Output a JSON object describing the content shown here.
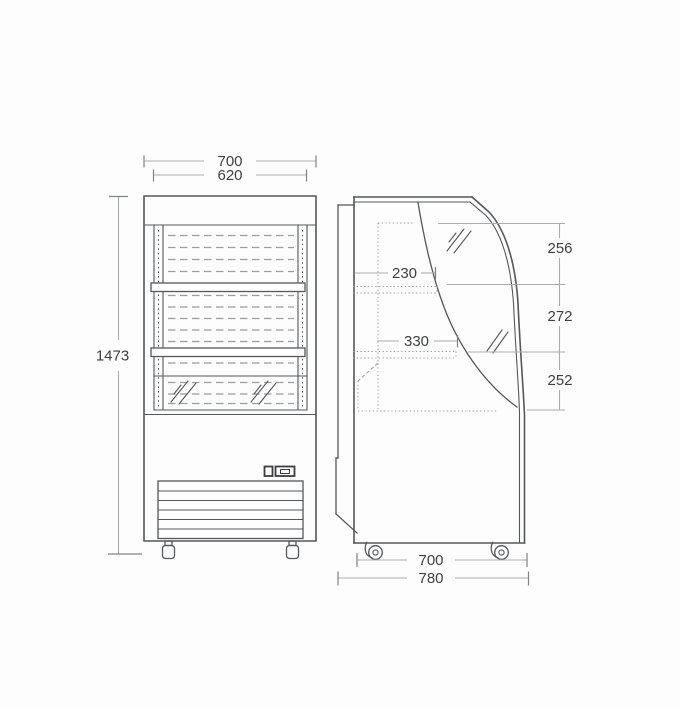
{
  "drawing": {
    "kind": "technical-dimension-drawing",
    "subject": "open-front refrigerated display cooler, front and side elevation"
  },
  "dimensions": {
    "front_width_outer": "700",
    "front_width_inner": "620",
    "front_height": "1473",
    "side_shelf_depth_upper": "230",
    "side_shelf_depth_lower": "330",
    "side_front_segment_top": "256",
    "side_front_segment_middle": "272",
    "side_front_segment_bottom": "252",
    "side_depth_body": "700",
    "side_depth_overall": "780"
  },
  "colors": {
    "background": "#fdfdfd",
    "outline": "#55575a",
    "dimline": "#aaacae",
    "tick": "#808285",
    "dash": "#9b9da0",
    "text": "#3f4043"
  }
}
